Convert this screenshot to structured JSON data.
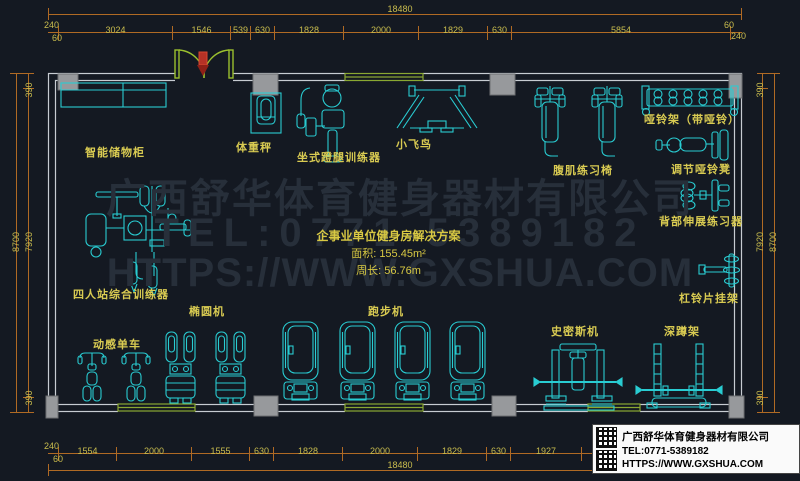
{
  "colors": {
    "background": "#141922",
    "equipment": "#29ccd2",
    "dimension_line": "#b06a24",
    "dimension_text": "#c9bd4e",
    "label_text": "#d9cb52",
    "window": "#8aa832",
    "watermark": "#272f3a",
    "center_text": "#d8c943"
  },
  "dims": {
    "top": {
      "overall": "18480",
      "pre": [
        "240",
        "60"
      ],
      "segments": [
        "3024",
        "1546",
        "539",
        "630",
        "1828",
        "2000",
        "1829",
        "630",
        "5854"
      ],
      "post": [
        "60",
        "240"
      ]
    },
    "bottom": {
      "overall": "18480",
      "pre": [
        "240",
        "60"
      ],
      "segments": [
        "1554",
        "2000",
        "1555",
        "630",
        "1828",
        "2000",
        "1829",
        "630",
        "1927"
      ]
    },
    "left": {
      "overall": "8700",
      "top": "390",
      "middle": "7920",
      "bottom": "390"
    },
    "right": {
      "overall": "8700",
      "top": "390",
      "middle": "7920",
      "bottom": "390"
    }
  },
  "labels": [
    {
      "text": "智能储物柜"
    },
    {
      "text": "体重秤"
    },
    {
      "text": "坐式蹬腿训练器"
    },
    {
      "text": "小飞鸟"
    },
    {
      "text": "腹肌练习椅"
    },
    {
      "text": "哑铃架（带哑铃）"
    },
    {
      "text": "调节哑铃凳"
    },
    {
      "text": "背部伸展练习器"
    },
    {
      "text": "杠铃片挂架"
    },
    {
      "text": "四人站综合训练器"
    },
    {
      "text": "椭圆机"
    },
    {
      "text": "动感单车"
    },
    {
      "text": "跑步机"
    },
    {
      "text": "史密斯机"
    },
    {
      "text": "深蹲架"
    }
  ],
  "center_info": {
    "line1": "企事业单位健身房解决方案",
    "line2": "面积: 155.45m²",
    "line3": "周长: 56.76m"
  },
  "watermark": {
    "line1": "广西舒华体育健身器材有限公司",
    "line2": "TEL:0771-5389182",
    "line3": "HTTPS://WWW.GXSHUA.COM"
  },
  "info_box": {
    "company": "广西舒华体育健身器材有限公司",
    "tel": "TEL:0771-5389182",
    "url": "HTTPS://WWW.GXSHUA.COM",
    "qr1": "qr-code",
    "qr2": "qr-code"
  }
}
